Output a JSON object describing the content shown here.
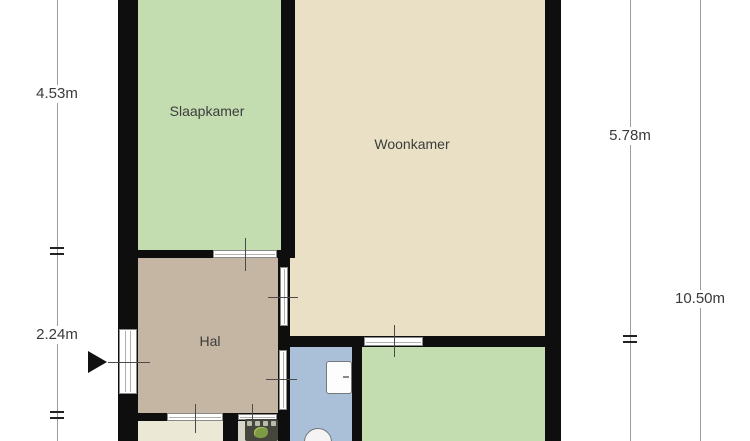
{
  "rooms": [
    {
      "name": "slaapkamer",
      "label": "Slaapkamer",
      "color": "#c4ddb0"
    },
    {
      "name": "woonkamer",
      "label": "Woonkamer",
      "color": "#e9e0c5"
    },
    {
      "name": "hal",
      "label": "Hal",
      "color": "#c5b6a3"
    },
    {
      "name": "bathroom",
      "color": "#a9c0d8"
    },
    {
      "name": "room-bottom-right",
      "color": "#c4ddb0"
    },
    {
      "name": "kitchen",
      "color": "#ece8d6"
    },
    {
      "name": "kitchen-nook",
      "color": "#d8d5c9"
    }
  ],
  "dimension_labels": {
    "left_upper": "4.53m",
    "left_lower": "2.24m",
    "right_inner": "5.78m",
    "right_outer": "10.50m"
  },
  "fixtures": {
    "sink": "sink",
    "toilet": "toilet",
    "stove": "stove",
    "entrance_arrow": "entrance-arrow"
  },
  "colors": {
    "wall": "#0e0e0e",
    "dimension_line": "#9b9b9b",
    "label_text": "#3a3a3a",
    "door_fill": "#ffffff",
    "door_frame": "#8a8a8a"
  }
}
